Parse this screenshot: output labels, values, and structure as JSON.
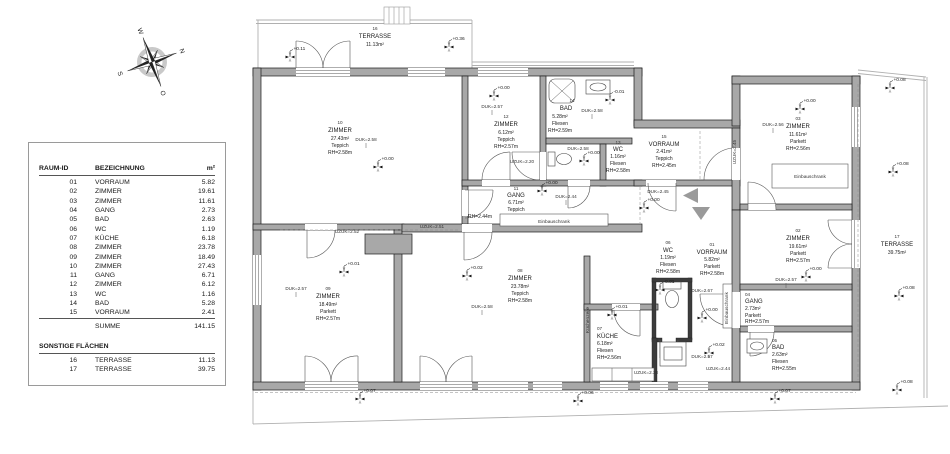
{
  "legend": {
    "col1": "RAUM-ID",
    "col2": "BEZEICHNUNG",
    "col3": "m²",
    "rows": [
      {
        "id": "01",
        "name": "VORRAUM",
        "area": "5.82"
      },
      {
        "id": "02",
        "name": "ZIMMER",
        "area": "19.61"
      },
      {
        "id": "03",
        "name": "ZIMMER",
        "area": "11.61"
      },
      {
        "id": "04",
        "name": "GANG",
        "area": "2.73"
      },
      {
        "id": "05",
        "name": "BAD",
        "area": "2.63"
      },
      {
        "id": "06",
        "name": "WC",
        "area": "1.19"
      },
      {
        "id": "07",
        "name": "KÜCHE",
        "area": "6.18"
      },
      {
        "id": "08",
        "name": "ZIMMER",
        "area": "23.78"
      },
      {
        "id": "09",
        "name": "ZIMMER",
        "area": "18.49"
      },
      {
        "id": "10",
        "name": "ZIMMER",
        "area": "27.43"
      },
      {
        "id": "11",
        "name": "GANG",
        "area": "6.71"
      },
      {
        "id": "12",
        "name": "ZIMMER",
        "area": "6.12"
      },
      {
        "id": "13",
        "name": "WC",
        "area": "1.16"
      },
      {
        "id": "14",
        "name": "BAD",
        "area": "5.28"
      },
      {
        "id": "15",
        "name": "VORRAUM",
        "area": "2.41"
      }
    ],
    "summe_label": "SUMME",
    "summe_value": "141.15",
    "section2": "SONSTIGE FLÄCHEN",
    "rows2": [
      {
        "id": "16",
        "name": "TERRASSE",
        "area": "11.13"
      },
      {
        "id": "17",
        "name": "TERRASSE",
        "area": "39.75"
      }
    ]
  },
  "compass": {
    "n": "N",
    "e": "O",
    "s": "S",
    "w": "W"
  },
  "plan": {
    "rooms": [
      {
        "num": "01",
        "name": "VORRAUM",
        "area": "5.82m²",
        "floor": "Parkett",
        "rh": "RH=2.58m"
      },
      {
        "num": "02",
        "name": "ZIMMER",
        "area": "19.61m²",
        "floor": "Parkett",
        "rh": "RH=2.57m"
      },
      {
        "num": "03",
        "name": "ZIMMER",
        "area": "11.61m²",
        "floor": "Parkett",
        "rh": "RH=2.56m"
      },
      {
        "num": "04",
        "name": "GANG",
        "area": "2.73m²",
        "floor": "Parkett",
        "rh": "RH=2.57m"
      },
      {
        "num": "05",
        "name": "BAD",
        "area": "2.63m²",
        "floor": "Fliesen",
        "rh": "RH=2.55m"
      },
      {
        "num": "06",
        "name": "WC",
        "area": "1.19m²",
        "floor": "Fliesen",
        "rh": "RH=2.58m"
      },
      {
        "num": "07",
        "name": "KÜCHE",
        "area": "6.18m²",
        "floor": "Fliesen",
        "rh": "RH=2.56m"
      },
      {
        "num": "08",
        "name": "ZIMMER",
        "area": "23.78m²",
        "floor": "Teppich",
        "rh": "RH=2.58m"
      },
      {
        "num": "09",
        "name": "ZIMMER",
        "area": "18.49m²",
        "floor": "Parkett",
        "rh": "RH=2.57m"
      },
      {
        "num": "10",
        "name": "ZIMMER",
        "area": "27.43m²",
        "floor": "Teppich",
        "rh": "RH=2.58m"
      },
      {
        "num": "11",
        "name": "GANG",
        "area": "6.71m²",
        "floor": "Teppich",
        "rh": "RH=2.44m"
      },
      {
        "num": "12",
        "name": "ZIMMER",
        "area": "6.12m²",
        "floor": "Teppich",
        "rh": "RH=2.57m"
      },
      {
        "num": "13",
        "name": "WC",
        "area": "1.16m²",
        "floor": "Fliesen",
        "rh": "RH=2.58m"
      },
      {
        "num": "14",
        "name": "BAD",
        "area": "5.28m²",
        "floor": "Fliesen",
        "rh": "RH=2.59m"
      },
      {
        "num": "15",
        "name": "VORRAUM",
        "area": "2.41m²",
        "floor": "Teppich",
        "rh": "RH=2.45m"
      }
    ],
    "terraces": [
      {
        "num": "16",
        "name": "TERRASSE",
        "area": "11.13m²"
      },
      {
        "num": "17",
        "name": "TERRASSE",
        "area": "39.75m²"
      }
    ],
    "markers": [
      "+0.11",
      "+0.36",
      "+0.00",
      "+0.00",
      "-0.01",
      "+0.00",
      "+0.00",
      "+0.08",
      "+0.08",
      "+0.08",
      "+0.00",
      "+0.00",
      "+0.00",
      "+0.00",
      "-0.01",
      "+0.01",
      "+0.02",
      "+0.02",
      "+0.01",
      "+0.07",
      "+0.06",
      "+0.07",
      "+0.08"
    ],
    "duk": [
      "DUK=2.58",
      "DUK=2.57",
      "DUK=2.58",
      "DUK=2.58",
      "DUK=2.45",
      "DUK=2.44",
      "DUK=2.56",
      "DUK=2.57",
      "DUK=2.57",
      "DUK=2.58",
      "DUK=2.67",
      "DUK=2.57"
    ],
    "uzuk": [
      "UZUK=2.52",
      "UZUK=2.51",
      "UZUK=2.20",
      "UZUK=2.45",
      "UZUK=2.44",
      "UZUK=2.28"
    ],
    "annotations": {
      "einbauschrank": "Einbauschrank",
      "kuechenzeile": "Küchenzeile"
    }
  }
}
